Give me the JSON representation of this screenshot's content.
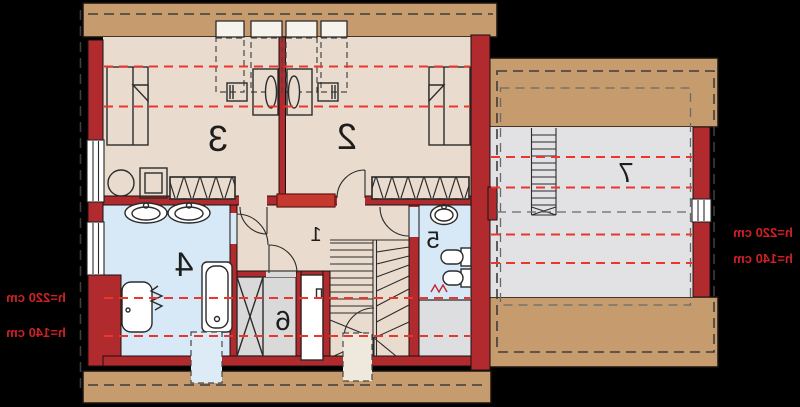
{
  "plan": {
    "type": "attic-floor-plan-mirrored",
    "rooms": [
      {
        "number": "1"
      },
      {
        "number": "2"
      },
      {
        "number": "3"
      },
      {
        "number": "4"
      },
      {
        "number": "5"
      },
      {
        "number": "6"
      },
      {
        "number": "7"
      }
    ],
    "height_labels": {
      "left": [
        {
          "text": "h=220 cm"
        },
        {
          "text": "h=140 cm"
        }
      ],
      "right": [
        {
          "text": "h=220 cm"
        },
        {
          "text": "h=140 cm"
        }
      ]
    },
    "symbols": [
      "bed",
      "wardrobe",
      "desk",
      "chair",
      "roof-window",
      "window",
      "door-swing",
      "staircase",
      "ladder",
      "bathtub",
      "washbasin",
      "toilet",
      "bidet",
      "radiator",
      "washing-machine",
      "chimney"
    ],
    "colors": {
      "background": "#000000",
      "wood_band": "#c69b6d",
      "floor": "#e9dccf",
      "bathroom_floor": "#d7e9f6",
      "closet_floor": "#d9d9d9",
      "attic_floor": "#e2e2e4",
      "storage_floor": "#dcdee0",
      "wall": "#b02a2e",
      "chimney": "#c5392f",
      "height_line": "#ea362d",
      "height_label": "#cc2127",
      "outline": "#2b2b2b",
      "dash_dark": "#3c3c3c",
      "dash_gray": "#6a6a6a",
      "window_fill": "#ffffff",
      "skylight_fill": "#f6f2ec"
    }
  }
}
